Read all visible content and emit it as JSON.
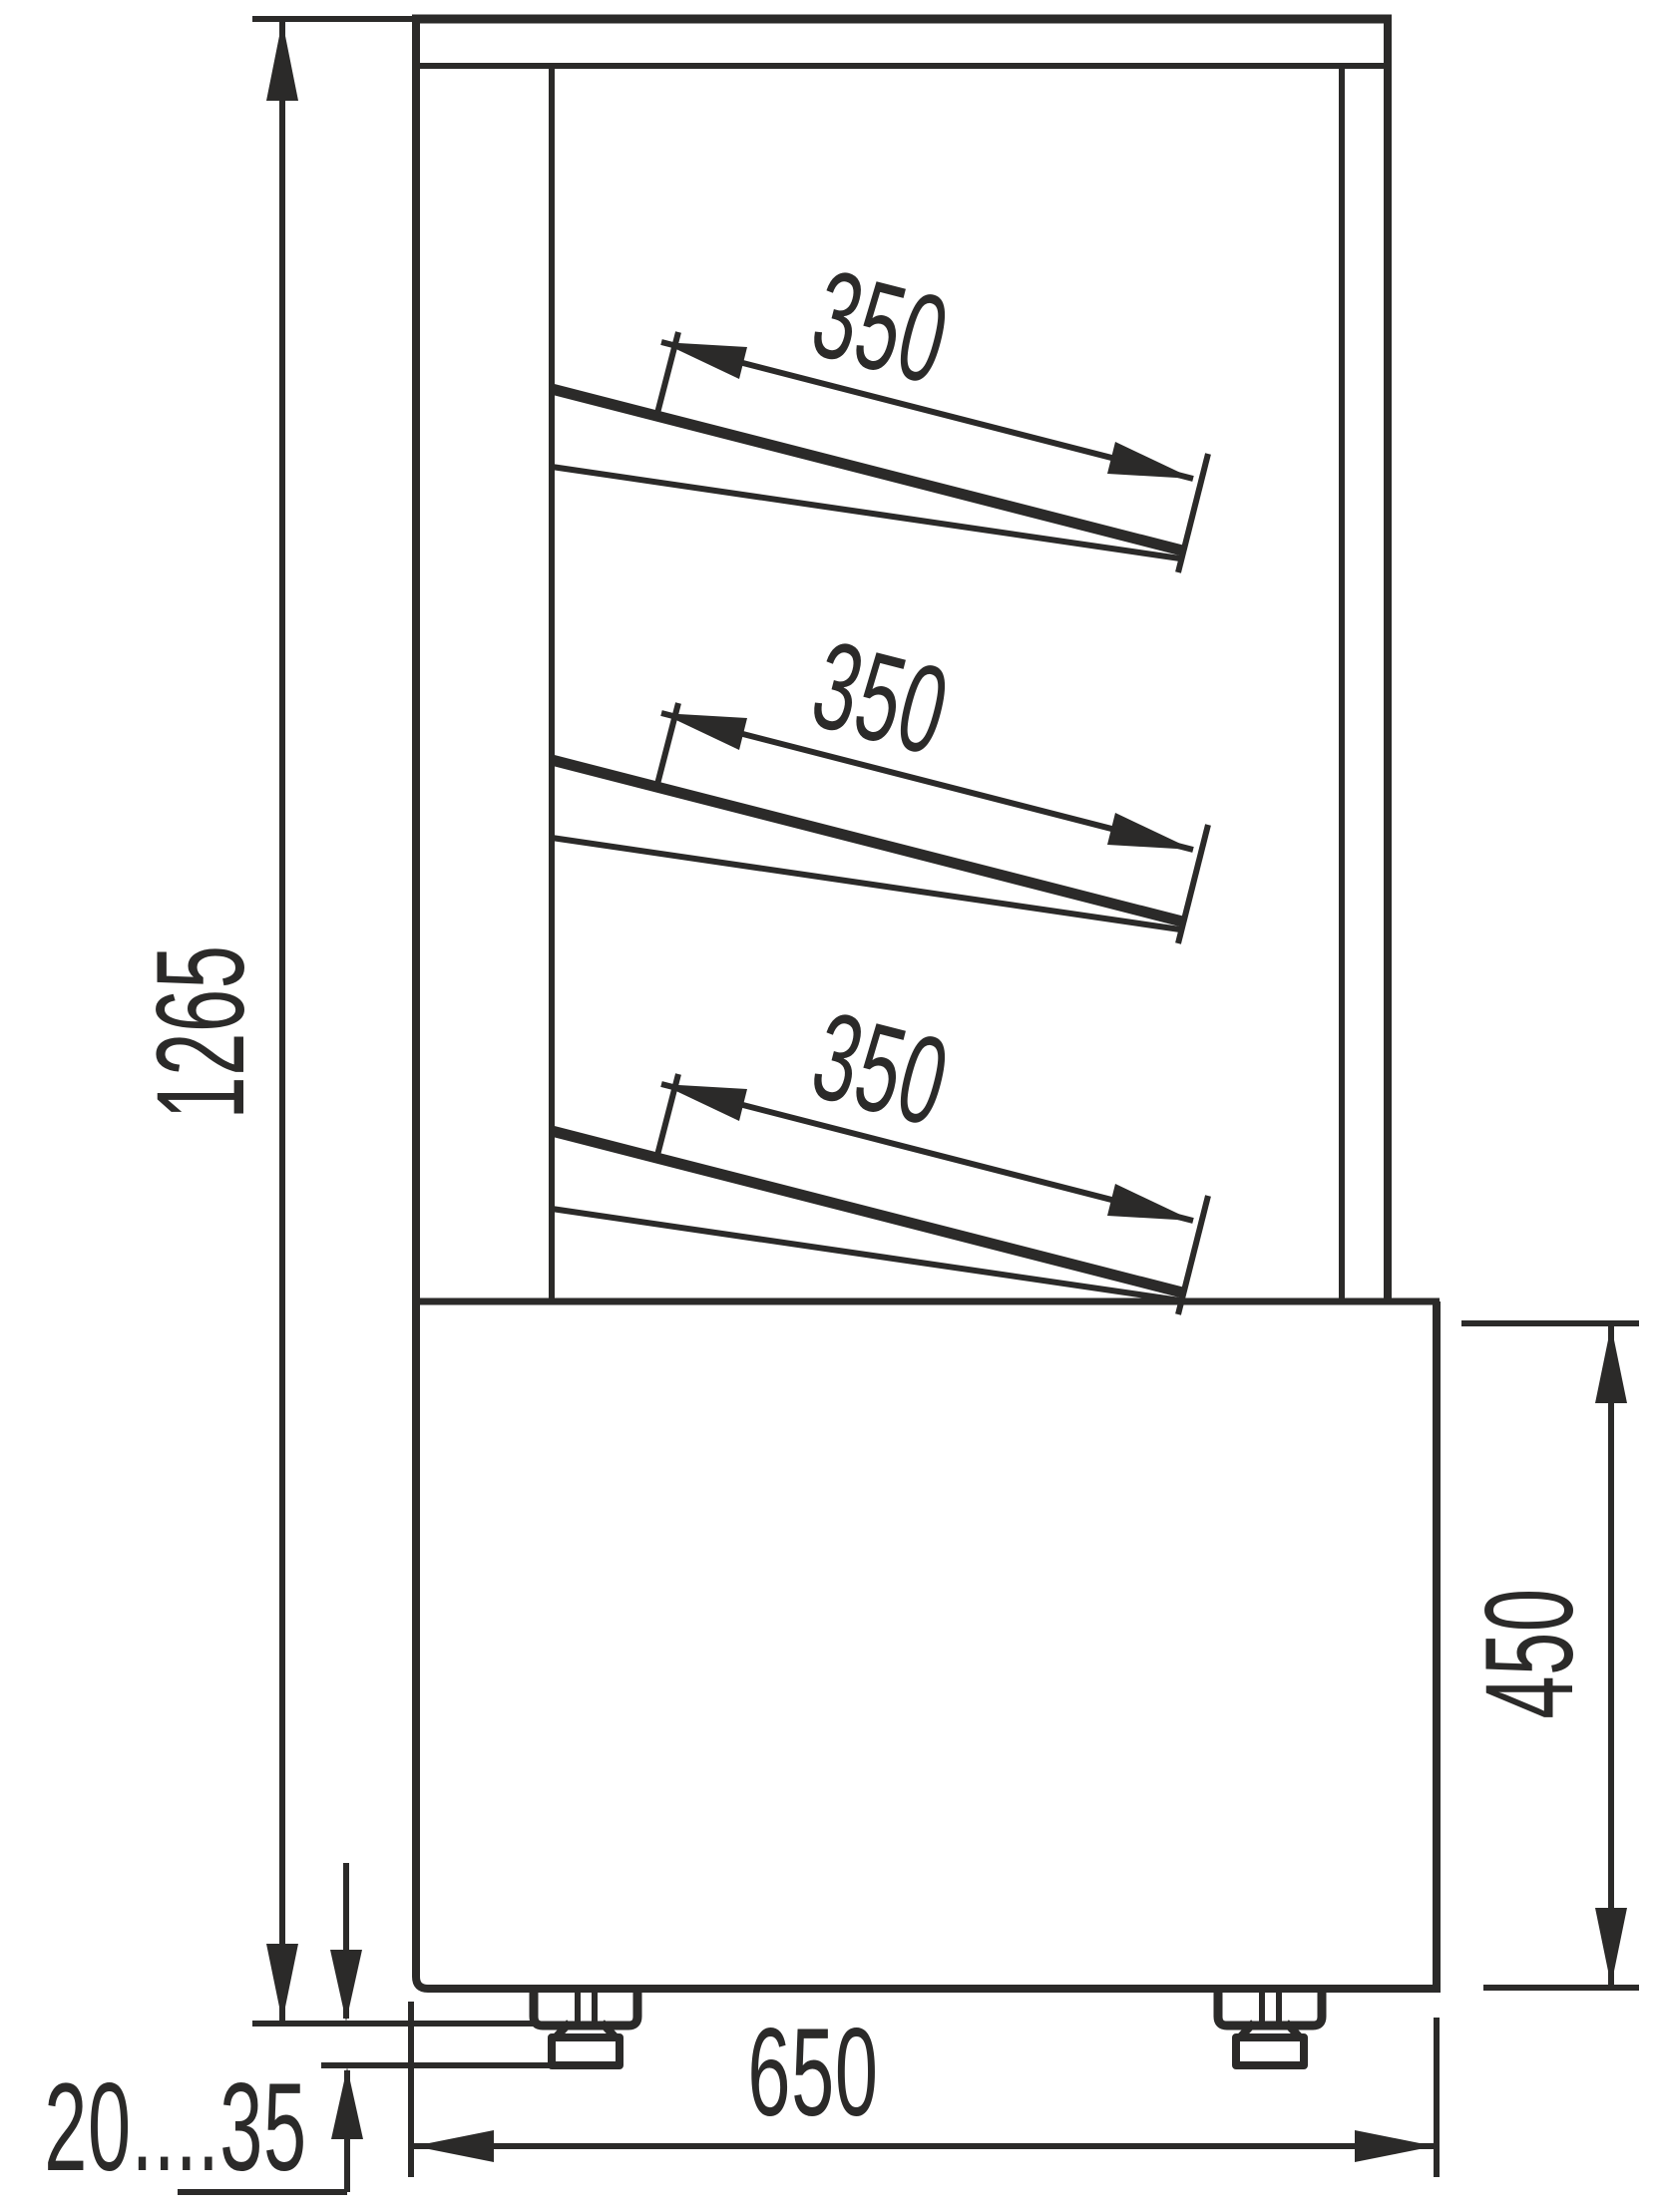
{
  "page": {
    "background": "#ffffff",
    "ink_color": "#2b2a29"
  },
  "dimensions": {
    "overall_height": {
      "label": "1265"
    },
    "shelves": [
      {
        "label": "350"
      },
      {
        "label": "350"
      },
      {
        "label": "350"
      }
    ],
    "base_height": {
      "label": "450"
    },
    "overall_width": {
      "label": "650"
    },
    "leg_adjustment": {
      "label": "20....35"
    }
  }
}
